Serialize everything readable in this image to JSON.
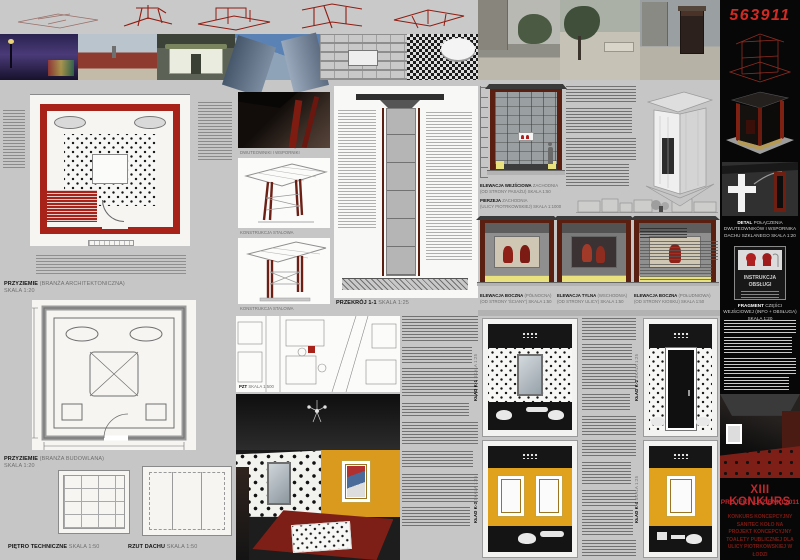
{
  "header": {
    "competition_number": "563911"
  },
  "plans": {
    "ground_arch": {
      "title": "PRZYZIEMIE",
      "subtitle": "(BRANŻA ARCHITEKTONICZNA)",
      "scale": "SKALA 1:20"
    },
    "ground_constr": {
      "title": "PRZYZIEMIE",
      "subtitle": "(BRANŻA BUDOWLANA)",
      "scale": "SKALA 1:20"
    },
    "tech_floor": {
      "title": "PIĘTRO TECHNICZNE",
      "scale": "SKALA 1:50"
    },
    "roof": {
      "title": "RZUT DACHU",
      "scale": "SKALA 1:50"
    },
    "site": {
      "title": "PZT",
      "scale": "SKALA 1:500"
    }
  },
  "structure": {
    "beams_render_label": "DWUTEOWNIKI I WSPORNIKI",
    "steel_render_1_label": "KONSTRUKCJA STALOWA",
    "steel_render_2_label": "KONSTRUKCJA STALOWA",
    "section": {
      "title": "PRZEKRÓJ 1-1",
      "scale": "SKALA 1:25"
    }
  },
  "elevations": {
    "entry": {
      "title": "ELEWACJA WEJŚCIOWA",
      "subtitle": "ZACHODNIA",
      "note": "(OD STRONY PASAŻU)",
      "scale": "SKALA 1:50"
    },
    "frontage": {
      "title": "PIERZEJA",
      "subtitle": "ZACHODNIA",
      "note": "(ULICY PIOTRKOWSKIEJ)",
      "scale": "SKALA 1:1000"
    },
    "row": [
      {
        "title": "ELEWACJA BOCZNA",
        "subtitle": "(PÓŁNOCNA)",
        "note": "(OD STRONY 'ŚCIANY')",
        "scale": "SKALA 1:50"
      },
      {
        "title": "ELEWACJA TYLNA",
        "subtitle": "(WSCHODNIA)",
        "note": "(OD STRONY ULICY)",
        "scale": "SKALA 1:50"
      },
      {
        "title": "ELEWACJA BOCZNA",
        "subtitle": "(POŁUDNIOWA)",
        "note": "(OD STRONY KIOSKU)",
        "scale": "SKALA 1:50"
      }
    ]
  },
  "interior_elevations": [
    {
      "label": "KŁAD K-1",
      "scale": "SKALA 1:25"
    },
    {
      "label": "KŁAD K-2",
      "scale": "SKALA 1:25"
    },
    {
      "label": "KŁAD K-3",
      "scale": "SKALA 1:25"
    },
    {
      "label": "KŁAD K-4",
      "scale": "SKALA 1:25"
    }
  ],
  "details": {
    "detail_title": "DETAL",
    "detail_text": "POŁĄCZENIA DWUTEOWNIKÓW I WSPORNIKA DACHU SZKLANEGO SKALA 1:20",
    "instruction_sign_title": "INSTRUKCJA OBSŁUGI",
    "fragment_title": "FRAGMENT",
    "fragment_text": "CZĘŚCI WEJŚCIOWEJ (INFO + OBSŁUGA) SKALA 1:20"
  },
  "footer": {
    "competition": "XIII KONKURS",
    "project": "PROJEKT ŁAZIENKI 2011",
    "description": "KONKURS KONCEPCYJNY SANITEC KOŁO NA PROJEKT KONCEPCYJNY TOALETY PUBLICZNEJ DLA ULICY PIOTRKOWSKIEJ W ŁODZI"
  },
  "colors": {
    "accent_red": "#c1272d",
    "maroon_frame": "#5b1f12",
    "plan_red": "#a8221a",
    "amber_wall": "#e0a11c",
    "carpet_red": "#7e1f17",
    "panel_black": "#070707",
    "board_grey": "#c6c6c6"
  },
  "icons": {
    "instruction_heads": "male-female-profile-icons",
    "chandelier": "chandelier-icon",
    "scale_figure": "human-scale-figure-icon"
  }
}
